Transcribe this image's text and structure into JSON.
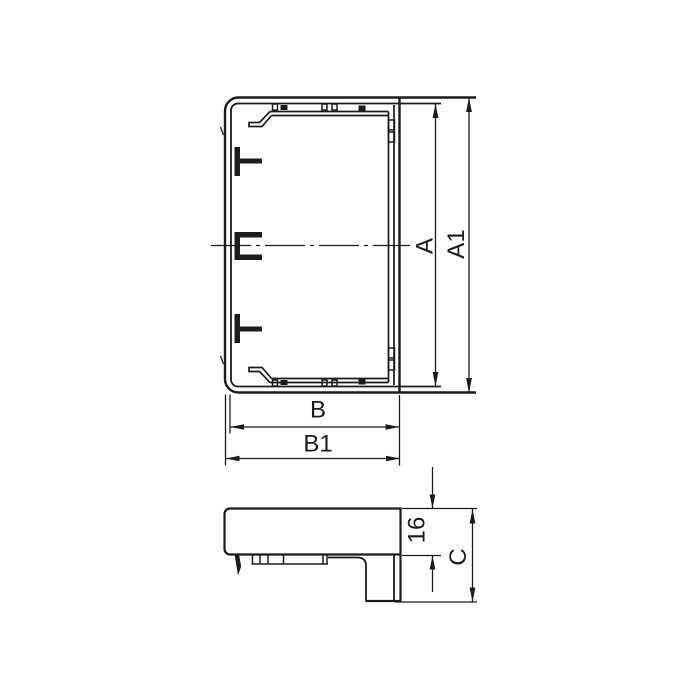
{
  "drawing": {
    "background": "#ffffff",
    "line_color": "#1b1b1b",
    "views": {
      "front_view": {
        "dim_inner_height": "A",
        "dim_outer_height": "A1",
        "dim_inner_width": "B",
        "dim_outer_width": "B1"
      },
      "side_view": {
        "dim_cover_height": "16",
        "dim_overall_depth": "C"
      }
    }
  }
}
